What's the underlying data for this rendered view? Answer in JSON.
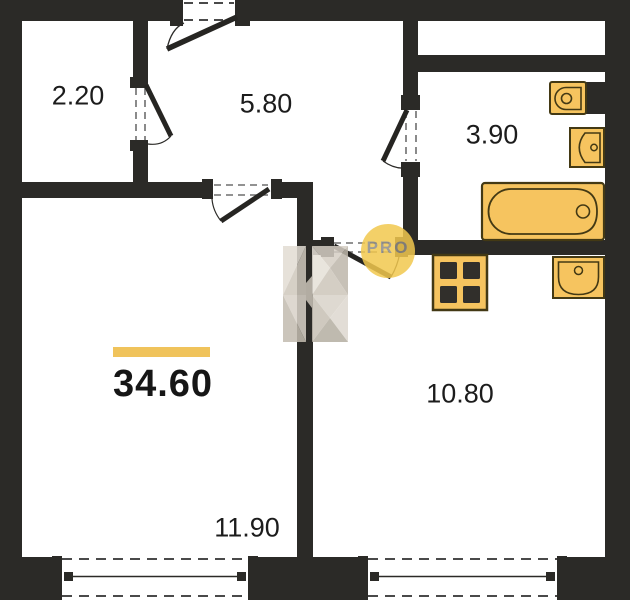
{
  "plan": {
    "type": "apartment-floor-plan",
    "total_area": {
      "value": "34.60"
    },
    "rooms": [
      {
        "name": "closet",
        "area": "2.20"
      },
      {
        "name": "hallway",
        "area": "5.80"
      },
      {
        "name": "bathroom",
        "area": "3.90"
      },
      {
        "name": "kitchen",
        "area": "10.80"
      },
      {
        "name": "living-room",
        "area": "11.90"
      }
    ]
  },
  "watermark": {
    "label": "PRO"
  },
  "icons": [
    "toilet-icon",
    "washbasin-icon",
    "bathtub-icon",
    "stove-icon",
    "kitchen-sink-icon",
    "entrance-door-icon",
    "closet-door-icon",
    "bathroom-door-icon",
    "living-room-door-icon",
    "kitchen-door-icon",
    "window-icon"
  ],
  "colors": {
    "wall": "#2b2a27",
    "fixture_fill": "#f6c45f",
    "fixture_stroke": "#433914",
    "accent_bar": "#f0c35b",
    "watermark_circle": "#f2c84e",
    "watermark_text": "#8e8b85",
    "label_text": "#1c1c1c"
  }
}
